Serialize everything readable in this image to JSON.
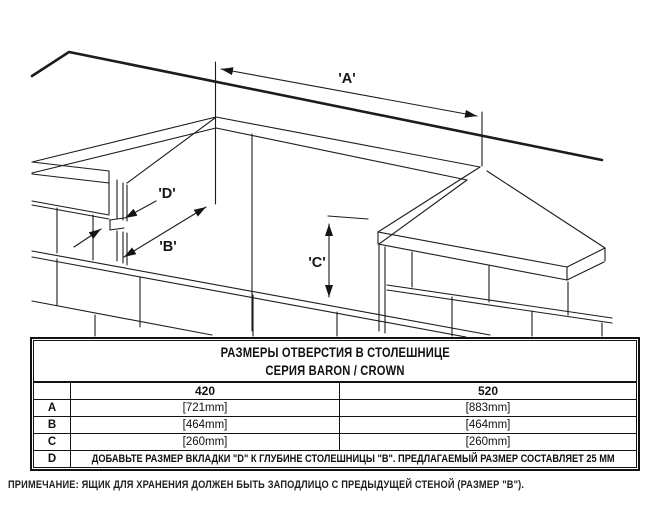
{
  "drawing": {
    "dim_labels": {
      "a": "'A'",
      "b": "'B'",
      "c": "'C'",
      "d": "'D'"
    }
  },
  "table": {
    "title_line1": "РАЗМЕРЫ ОТВЕРСТИЯ В СТОЛЕШНИЦЕ",
    "title_line2": "СЕРИЯ BARON / CROWN",
    "col_headers": [
      "420",
      "520"
    ],
    "rows": [
      {
        "label": "A",
        "v420": "[721mm]",
        "v520": "[883mm]"
      },
      {
        "label": "B",
        "v420": "[464mm]",
        "v520": "[464mm]"
      },
      {
        "label": "C",
        "v420": "[260mm]",
        "v520": "[260mm]"
      }
    ],
    "d_row": {
      "label": "D",
      "text": "ДОБАВЬТЕ РАЗМЕР ВКЛАДКИ \"D\" К ГЛУБИНЕ СТОЛЕШНИЦЫ \"B\". ПРЕДЛАГАЕМЫЙ РАЗМЕР СОСТАВЛЯЕТ 25 ММ"
    }
  },
  "footnote": "ПРИМЕЧАНИЕ: ЯЩИК ДЛЯ ХРАНЕНИЯ ДОЛЖЕН БЫТЬ ЗАПОДЛИЦО С ПРЕДЫДУЩЕЙ СТЕНОЙ (РАЗМЕР \"B\").",
  "colors": {
    "line": "#1c1c1c",
    "background": "#ffffff"
  }
}
